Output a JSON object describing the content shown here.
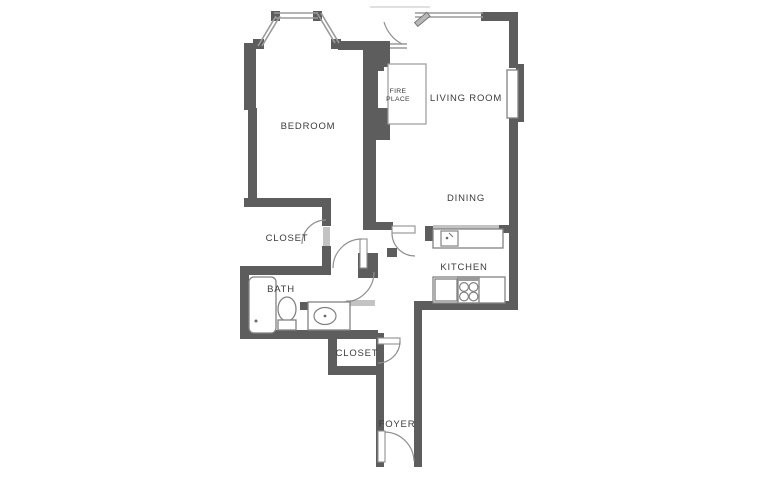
{
  "title": "Apartment floor plan",
  "rooms": {
    "bedroom": "BEDROOM",
    "living_room": "LIVING ROOM",
    "dining": "DINING",
    "kitchen": "KITCHEN",
    "bedroom_closet": "CLOSET",
    "bath": "BATH",
    "hall_closet": "CLOSET",
    "foyer": "FOYER"
  },
  "fireplace": {
    "line1": "FIRE",
    "line2": "PLACE"
  },
  "fixtures": [
    "bathtub",
    "toilet",
    "vanity-sink",
    "kitchen-sink",
    "stove",
    "counter",
    "fireplace-hearth"
  ],
  "colors": {
    "wall": "#5d5d5d",
    "door_line": "#8f8f8f",
    "window_line": "#9a9a9a",
    "label_text": "#3c3c3c",
    "background": "#ffffff"
  }
}
